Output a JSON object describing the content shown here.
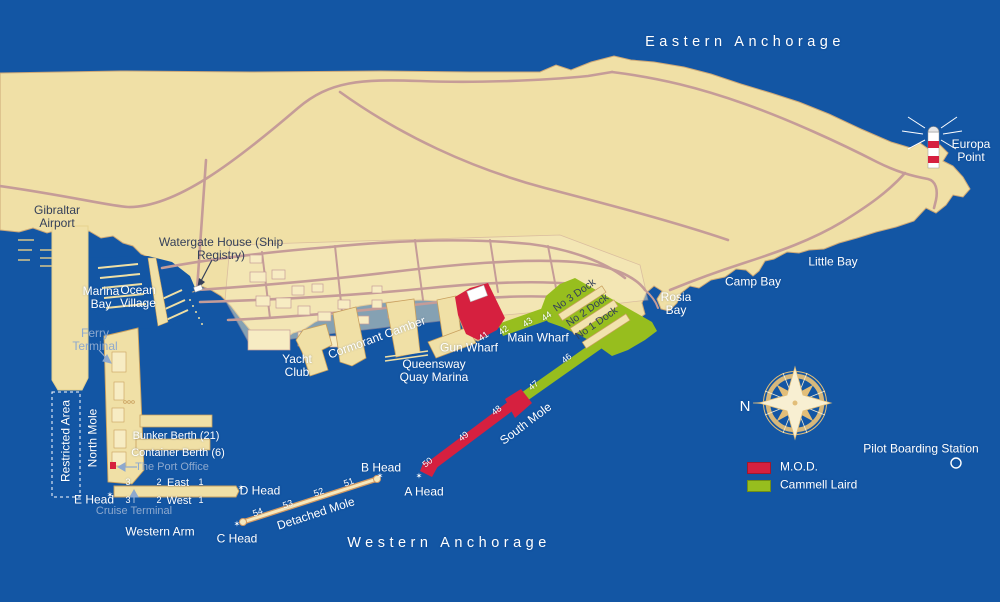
{
  "colors": {
    "sea": "#1356A4",
    "land": "#F0E0A6",
    "building": "#F7ECC3",
    "road": "#C59C98",
    "coast": "#CDA877",
    "mole_edge": "#C9A05E",
    "mod_red": "#D6203F",
    "cammell_green": "#97BE1E",
    "dock_tan": "#F2E3AE",
    "detached_edge": "#D49A62",
    "detached_fill": "#F6E9BE",
    "compass_gold": "#E2BE79",
    "compass_cream": "#F8EFD2",
    "label_dark": "#35405A",
    "label_muted": "#8EA9CE"
  },
  "icons": {
    "beacon_star": "✶"
  },
  "anchorages": {
    "eastern": "Eastern Anchorage",
    "western": "Western Anchorage"
  },
  "places": {
    "europa_point": "Europa Point",
    "gibraltar_airport": "Gibraltar Airport",
    "watergate_house": "Watergate House (Ship Registry)",
    "marina_bay": "Marina Bay",
    "ocean_village": "Ocean Village",
    "ferry_terminal": "Ferry Terminal",
    "restricted_area": "Restricted Area",
    "north_mole": "North Mole",
    "bunker_berth": "Bunker Berth (21)",
    "container_berth": "Container Berth (6)",
    "port_office": "The Port Office",
    "cruise_terminal": "Cruise Terminal",
    "western_arm": "Western Arm",
    "detached_mole": "Detached Mole",
    "south_mole": "South Mole",
    "yacht_club": "Yacht Club",
    "cormorant_camber": "Cormorant Camber",
    "queensway_quay_marina": "Queensway Quay Marina",
    "gun_wharf": "Gun Wharf",
    "main_wharf": "Main Wharf",
    "rosia_bay": "Rosia Bay",
    "camp_bay": "Camp Bay",
    "little_bay": "Little Bay",
    "pilot_boarding_station": "Pilot Boarding Station"
  },
  "heads": {
    "a": "A Head",
    "b": "B Head",
    "c": "C Head",
    "d": "D Head",
    "e": "E Head"
  },
  "docks": {
    "no1": "No 1 Dock",
    "no2": "No 2 Dock",
    "no3": "No 3 Dock"
  },
  "berth_numbers": {
    "n41": "41",
    "n42": "42",
    "n43": "43",
    "n44": "44",
    "n46": "46",
    "n47": "47",
    "n48": "48",
    "n49": "49",
    "n50": "50",
    "n51": "51",
    "n52": "52",
    "n53": "53",
    "n54": "54"
  },
  "arm_berths": {
    "east": "East",
    "west": "West",
    "east_1": "1",
    "east_2": "2",
    "east_3": "3",
    "west_1": "1",
    "west_2": "2",
    "west_3": "3"
  },
  "compass": {
    "north": "N"
  },
  "legend": {
    "mod": "M.O.D.",
    "cammell_laird": "Cammell Laird"
  }
}
